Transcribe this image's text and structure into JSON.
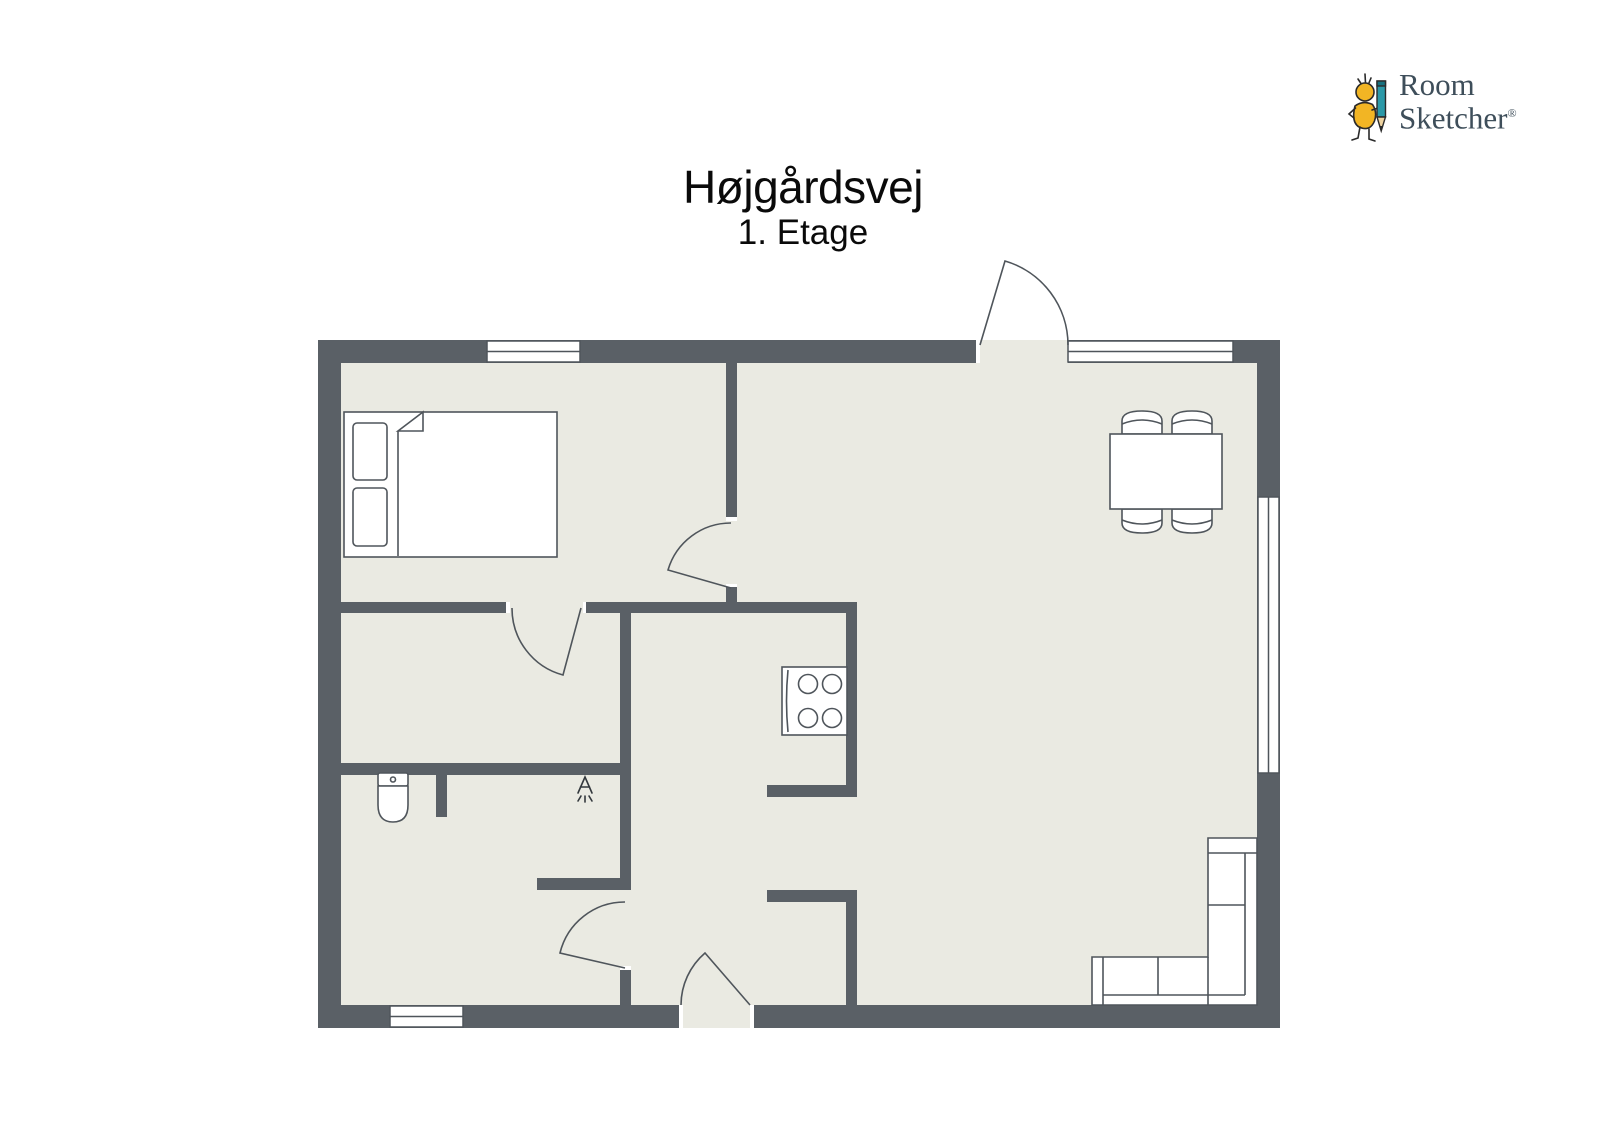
{
  "title": {
    "name": "Højgårdsvej",
    "floor": "1. Etage"
  },
  "logo": {
    "line1": "Room",
    "line2": "Sketcher",
    "registered": "®"
  },
  "colors": {
    "wall": "#5a6066",
    "floor": "#eaeae2",
    "background": "#ffffff",
    "furniture_outline": "#4f555b",
    "logo_text": "#3e4e5a",
    "logo_yellow": "#f2b524",
    "logo_teal": "#2b99a8"
  },
  "floorplan": {
    "windows_count": 4,
    "exterior_doors_count": 2,
    "interior_doors_count": 3,
    "furniture": [
      "double-bed-with-two-pillows",
      "dining-table-with-four-chairs",
      "stove-four-burners",
      "toilet",
      "shower-head-symbol",
      "corner-sofa"
    ]
  }
}
